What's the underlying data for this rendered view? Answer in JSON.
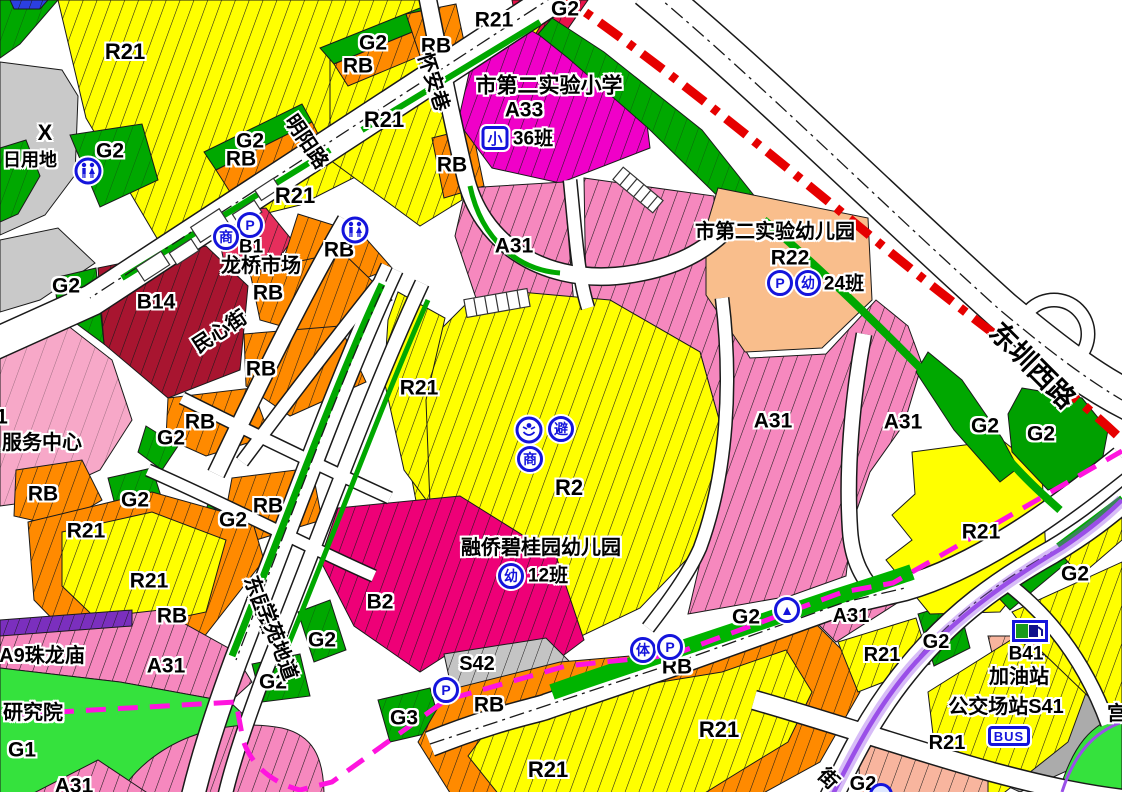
{
  "map": {
    "colors": {
      "residential_yellow": "#FFFF00",
      "education_pink": "#F688BE",
      "school_magenta": "#F000C8",
      "commercial_b2": "#EE0077",
      "market_b14": "#A81530",
      "market_b1": "#E62E5C",
      "mixed_rb_orange": "#FF8A00",
      "kindergarten_peach": "#F9BE8C",
      "green_g2": "#00A800",
      "green_g1": "#35E23D",
      "gray_land": "#C9C9C9",
      "station_gray": "#ABABAB",
      "salmon": "#F8B59E",
      "temple_purple": "#7B2FBE",
      "boundary_red": "#E60000",
      "boundary_magenta": "#FF14DE",
      "transit_purple": "#9A4FE8",
      "icon_blue": "#1414DC"
    },
    "labels": [
      {
        "t": "R21",
        "x": 125,
        "y": 52,
        "s": 22
      },
      {
        "t": "G2",
        "x": 373,
        "y": 43,
        "s": 21
      },
      {
        "t": "RB",
        "x": 358,
        "y": 66,
        "s": 21
      },
      {
        "t": "RB",
        "x": 436,
        "y": 46,
        "s": 21
      },
      {
        "t": "R21",
        "x": 494,
        "y": 20,
        "s": 21
      },
      {
        "t": "G2",
        "x": 565,
        "y": 9,
        "s": 21
      },
      {
        "t": "R21",
        "x": 384,
        "y": 120,
        "s": 22
      },
      {
        "t": "RB",
        "x": 452,
        "y": 165,
        "s": 21
      },
      {
        "t": "X",
        "x": 45,
        "y": 133,
        "s": 22,
        "n": "land-x-label"
      },
      {
        "t": "日用地",
        "x": 30,
        "y": 160,
        "s": 18,
        "n": "daily-land-label"
      },
      {
        "t": "G2",
        "x": 110,
        "y": 151,
        "s": 21
      },
      {
        "t": "G2",
        "x": 250,
        "y": 141,
        "s": 21
      },
      {
        "t": "RB",
        "x": 241,
        "y": 159,
        "s": 21
      },
      {
        "t": "R21",
        "x": 295,
        "y": 196,
        "s": 22
      },
      {
        "t": "B1",
        "x": 251,
        "y": 247,
        "s": 19
      },
      {
        "t": "龙桥市场",
        "x": 261,
        "y": 266,
        "s": 20,
        "n": "market-name"
      },
      {
        "t": "RB",
        "x": 339,
        "y": 250,
        "s": 21
      },
      {
        "t": "市第二实验小学",
        "x": 549,
        "y": 86,
        "s": 21,
        "n": "primary-school-name"
      },
      {
        "t": "A33",
        "x": 524,
        "y": 110,
        "s": 21
      },
      {
        "t": "36班",
        "x": 533,
        "y": 139,
        "s": 19,
        "n": "primary-school-class-count"
      },
      {
        "t": "市第二实验幼儿园",
        "x": 775,
        "y": 232,
        "s": 20,
        "n": "kindergarten2-name"
      },
      {
        "t": "R22",
        "x": 790,
        "y": 258,
        "s": 21
      },
      {
        "t": "24班",
        "x": 844,
        "y": 284,
        "s": 19,
        "n": "kindergarten2-class-count"
      },
      {
        "t": "G2",
        "x": 66,
        "y": 286,
        "s": 21
      },
      {
        "t": "B14",
        "x": 156,
        "y": 302,
        "s": 21
      },
      {
        "t": "RB",
        "x": 268,
        "y": 293,
        "s": 21
      },
      {
        "t": "RB",
        "x": 261,
        "y": 369,
        "s": 21
      },
      {
        "t": "RB",
        "x": 200,
        "y": 422,
        "s": 21
      },
      {
        "t": "G2",
        "x": 171,
        "y": 438,
        "s": 21
      },
      {
        "t": "1",
        "x": 2,
        "y": 417,
        "s": 21
      },
      {
        "t": "服务中心",
        "x": 42,
        "y": 443,
        "s": 20,
        "n": "service-center-label"
      },
      {
        "t": "RB",
        "x": 43,
        "y": 494,
        "s": 21
      },
      {
        "t": "G2",
        "x": 135,
        "y": 500,
        "s": 21
      },
      {
        "t": "RB",
        "x": 268,
        "y": 506,
        "s": 21
      },
      {
        "t": "G2",
        "x": 233,
        "y": 520,
        "s": 21
      },
      {
        "t": "R21",
        "x": 86,
        "y": 531,
        "s": 21
      },
      {
        "t": "R21",
        "x": 149,
        "y": 581,
        "s": 21
      },
      {
        "t": "RB",
        "x": 172,
        "y": 616,
        "s": 21
      },
      {
        "t": "A9珠龙庙",
        "x": 42,
        "y": 656,
        "s": 20,
        "n": "temple-label"
      },
      {
        "t": "A31",
        "x": 166,
        "y": 666,
        "s": 21
      },
      {
        "t": "研究院",
        "x": 33,
        "y": 713,
        "s": 20,
        "n": "institute-label"
      },
      {
        "t": "G1",
        "x": 22,
        "y": 750,
        "s": 21
      },
      {
        "t": "A31",
        "x": 74,
        "y": 786,
        "s": 21
      },
      {
        "t": "A31",
        "x": 514,
        "y": 246,
        "s": 21
      },
      {
        "t": "A31",
        "x": 773,
        "y": 421,
        "s": 21
      },
      {
        "t": "A31",
        "x": 903,
        "y": 422,
        "s": 21
      },
      {
        "t": "G2",
        "x": 985,
        "y": 426,
        "s": 21
      },
      {
        "t": "G2",
        "x": 1041,
        "y": 434,
        "s": 21
      },
      {
        "t": "R2",
        "x": 569,
        "y": 488,
        "s": 22
      },
      {
        "t": "R21",
        "x": 419,
        "y": 388,
        "s": 21
      },
      {
        "t": "融侨碧桂园幼儿园",
        "x": 541,
        "y": 548,
        "s": 20,
        "n": "kindergarten-rongqiao-name"
      },
      {
        "t": "12班",
        "x": 548,
        "y": 576,
        "s": 19,
        "n": "kindergarten-rongqiao-class-count"
      },
      {
        "t": "B2",
        "x": 380,
        "y": 602,
        "s": 21
      },
      {
        "t": "G2",
        "x": 322,
        "y": 640,
        "s": 21
      },
      {
        "t": "S42",
        "x": 477,
        "y": 664,
        "s": 20
      },
      {
        "t": "G3",
        "x": 404,
        "y": 718,
        "s": 21
      },
      {
        "t": "RB",
        "x": 489,
        "y": 705,
        "s": 21
      },
      {
        "t": "RB",
        "x": 677,
        "y": 667,
        "s": 21
      },
      {
        "t": "G2",
        "x": 746,
        "y": 617,
        "s": 21
      },
      {
        "t": "G2",
        "x": 273,
        "y": 682,
        "s": 21
      },
      {
        "t": "R21",
        "x": 548,
        "y": 770,
        "s": 22
      },
      {
        "t": "R21",
        "x": 719,
        "y": 730,
        "s": 22
      },
      {
        "t": "A31",
        "x": 851,
        "y": 616,
        "s": 20
      },
      {
        "t": "R21",
        "x": 882,
        "y": 655,
        "s": 20
      },
      {
        "t": "G2",
        "x": 936,
        "y": 642,
        "s": 20
      },
      {
        "t": "R21",
        "x": 947,
        "y": 743,
        "s": 20
      },
      {
        "t": "G2",
        "x": 863,
        "y": 784,
        "s": 20
      },
      {
        "t": "R21",
        "x": 981,
        "y": 532,
        "s": 21
      },
      {
        "t": "G2",
        "x": 1075,
        "y": 574,
        "s": 21
      },
      {
        "t": "B41",
        "x": 1026,
        "y": 654,
        "s": 19
      },
      {
        "t": "加油站",
        "x": 1019,
        "y": 677,
        "s": 20,
        "n": "gas-station-label"
      },
      {
        "t": "公交场站S41",
        "x": 1006,
        "y": 707,
        "s": 20,
        "n": "bus-depot-label"
      },
      {
        "t": "宫",
        "x": 1117,
        "y": 714,
        "s": 20,
        "n": "partial-right-edge-label"
      },
      {
        "t": "明阳路",
        "x": 306,
        "y": 142,
        "s": 20,
        "r": 56,
        "n": "road-label-mingyang"
      },
      {
        "t": "怀安巷",
        "x": 433,
        "y": 82,
        "s": 20,
        "r": 72,
        "n": "road-label-huaian"
      },
      {
        "t": "民心街",
        "x": 220,
        "y": 332,
        "s": 20,
        "r": -33,
        "n": "road-label-minxin"
      },
      {
        "t": "东园路",
        "x": 260,
        "y": 605,
        "s": 20,
        "r": 70,
        "n": "road-label-dongyuan"
      },
      {
        "t": "学苑地道",
        "x": 277,
        "y": 642,
        "s": 20,
        "r": 70,
        "n": "road-label-xueyuan-tunnel"
      },
      {
        "t": "东圳西路",
        "x": 1032,
        "y": 366,
        "s": 27,
        "r": 45,
        "n": "road-label-dongzhen-west"
      },
      {
        "t": "街",
        "x": 828,
        "y": 779,
        "s": 20,
        "r": 45,
        "n": "road-label-partial-street"
      }
    ],
    "icons": [
      {
        "type": "toilet",
        "n": "public-toilet-icon",
        "x": 88,
        "y": 171
      },
      {
        "type": "toilet",
        "n": "public-toilet-icon",
        "x": 355,
        "y": 230
      },
      {
        "type": "circle",
        "ch": "P",
        "n": "parking-icon",
        "x": 250,
        "y": 225
      },
      {
        "type": "circle",
        "ch": "商",
        "n": "commerce-icon",
        "x": 226,
        "y": 237
      },
      {
        "type": "circle",
        "ch": "P",
        "n": "parking-icon",
        "x": 780,
        "y": 283
      },
      {
        "type": "circle",
        "ch": "幼",
        "n": "kindergarten-icon",
        "x": 808,
        "y": 283
      },
      {
        "type": "square",
        "ch": "小",
        "n": "primary-school-icon",
        "x": 495,
        "y": 138
      },
      {
        "type": "person",
        "n": "community-welfare-icon",
        "x": 529,
        "y": 430
      },
      {
        "type": "circle",
        "ch": "避",
        "n": "emergency-shelter-icon",
        "x": 561,
        "y": 429
      },
      {
        "type": "circle",
        "ch": "商",
        "n": "commerce-icon",
        "x": 530,
        "y": 459
      },
      {
        "type": "circle",
        "ch": "幼",
        "n": "kindergarten-icon",
        "x": 511,
        "y": 576
      },
      {
        "type": "circle",
        "ch": "P",
        "n": "parking-icon",
        "x": 446,
        "y": 690
      },
      {
        "type": "circle",
        "ch": "体",
        "n": "sports-icon",
        "x": 643,
        "y": 650
      },
      {
        "type": "circle",
        "ch": "P",
        "n": "parking-icon",
        "x": 670,
        "y": 647
      },
      {
        "type": "circle",
        "ch": "▲",
        "n": "mound-icon",
        "x": 787,
        "y": 610
      },
      {
        "type": "fuel",
        "n": "gas-station-icon",
        "x": 1030,
        "y": 631
      },
      {
        "type": "bus",
        "ch": "BUS",
        "n": "bus-station-icon",
        "x": 1009,
        "y": 736
      },
      {
        "type": "partial",
        "n": "partial-circle-icon",
        "x": 881,
        "y": 795
      }
    ]
  }
}
